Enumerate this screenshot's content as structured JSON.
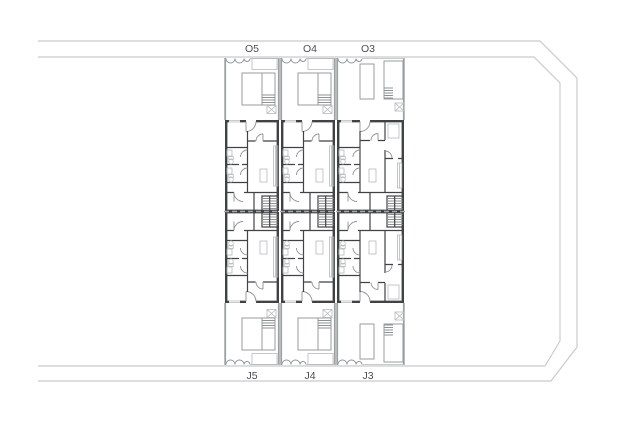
{
  "drawing": {
    "kind": "residential site / floor plan",
    "rows": 2,
    "units_per_row": 3
  },
  "labels": {
    "top": [
      {
        "text": "O5"
      },
      {
        "text": "O4"
      },
      {
        "text": "O3"
      }
    ],
    "bottom": [
      {
        "text": "J5"
      },
      {
        "text": "J4"
      },
      {
        "text": "J3"
      }
    ]
  },
  "symbols": {
    "door_swing": "quarter-circle-arc",
    "stairs": "ladder-hatch",
    "skylight": "crossed-box",
    "entrance_gate": "scalloped-arcs",
    "parking_space": "outlined-rectangle"
  },
  "colors": {
    "background": "#ffffff",
    "site_boundary": "#c8cbcd",
    "wall_dark": "#404245",
    "wall_medium": "#8f9294",
    "wall_light": "#b6b9bb",
    "yard_wall": "#9da0a2",
    "centerline": "#a4a7a9",
    "label_text": "#4b4d4f"
  }
}
